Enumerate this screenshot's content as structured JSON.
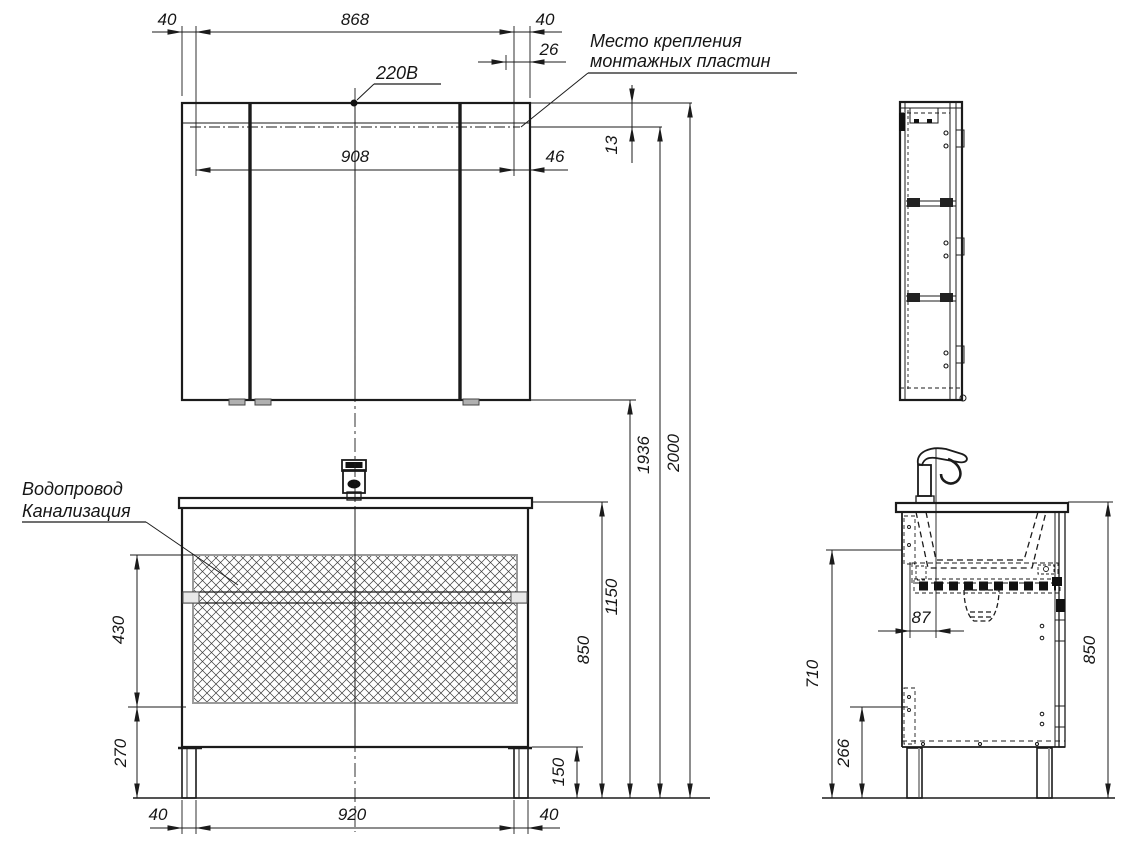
{
  "drawing": {
    "type": "bathroom furniture installation drawing",
    "annotations": {
      "mounting_plates_line1": "Место крепления",
      "mounting_plates_line2": "монтажных пластин",
      "power": "220В",
      "water_supply": "Водопровод",
      "sewerage": "Канализация"
    },
    "dimensions": {
      "mirror_top_left_offset": "40",
      "mirror_plate_span": "868",
      "mirror_top_right_offset": "40",
      "mirror_plate_inset": "26",
      "mirror_hinge_span": "908",
      "mirror_hinge_edge": "46",
      "mirror_plate_drop": "13",
      "height_mounting": "1936",
      "height_total": "2000",
      "height_mirror_bottom": "1150",
      "height_countertop": "850",
      "vanity_hatch_height": "430",
      "vanity_lower_height": "270",
      "vanity_leg_height": "150",
      "vanity_left_offset": "40",
      "vanity_leg_span": "920",
      "vanity_right_offset": "40",
      "side_faucet_offset": "87",
      "side_body_height": "710",
      "side_clearance": "266",
      "side_total_height": "850"
    },
    "colors": {
      "line": "#1b1b1b",
      "hatch_border": "#9a9a9a",
      "panel_gray": "#c8c8c8",
      "background": "#ffffff"
    }
  }
}
